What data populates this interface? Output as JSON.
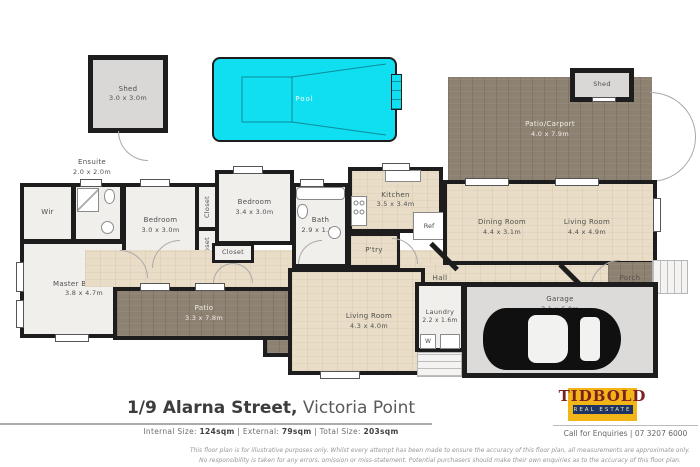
{
  "colors": {
    "wall": "#1d1d1d",
    "pool": "#10dff2",
    "wood_light": "#e9ddc7",
    "wood_dark": "#8d8172",
    "room_floor": "#f1efec",
    "garage_floor": "#dcdbd9",
    "logo_yellow": "#f2b517",
    "logo_navy": "#1d3465",
    "logo_maroon": "#7e1f1f"
  },
  "rooms": {
    "shed_tl": {
      "label": "Shed",
      "dims": "3.0 x 3.0m"
    },
    "pool": {
      "label": "Pool"
    },
    "patio_carport": {
      "label": "Patio/Carport",
      "dims": "4.0 x 7.9m"
    },
    "shed_tr": {
      "label": "Shed"
    },
    "ensuite": {
      "label": "Ensuite",
      "dims": "2.0 x 2.0m"
    },
    "wir": {
      "label": "Wir"
    },
    "bedroom_1": {
      "label": "Bedroom",
      "dims": "3.0 x 3.0m"
    },
    "bedroom_2": {
      "label": "Bedroom",
      "dims": "3.4 x 3.0m"
    },
    "closet_1": {
      "label": "Closet"
    },
    "closet_2": {
      "label": "Closet"
    },
    "closet_3": {
      "label": "Closet"
    },
    "bath": {
      "label": "Bath",
      "dims": "2.9 x 1.8m"
    },
    "kitchen": {
      "label": "Kitchen",
      "dims": "3.5 x 3.4m"
    },
    "pantry": {
      "label": "P'try"
    },
    "fridge": {
      "label": "Ref"
    },
    "dining": {
      "label": "Dining Room",
      "dims": "4.4 x 3.1m"
    },
    "living_main": {
      "label": "Living Room",
      "dims": "4.4 x 4.9m"
    },
    "hall_left": {
      "label": "Hall"
    },
    "hall_right": {
      "label": "Hall"
    },
    "master_bedroom": {
      "label": "Master Bedroom",
      "dims": "3.8 x 4.7m"
    },
    "patio": {
      "label": "Patio",
      "dims": "3.3 x 7.8m"
    },
    "living_2": {
      "label": "Living Room",
      "dims": "4.3 x 4.0m"
    },
    "laundry": {
      "label": "Laundry",
      "dims": "2.2 x 1.6m"
    },
    "washer": {
      "label": "W"
    },
    "garage": {
      "label": "Garage",
      "dims": "3.1 x 6.0m"
    },
    "porch": {
      "label": "Porch"
    }
  },
  "footer": {
    "address_primary": "1/9 Alarna Street,",
    "address_secondary": " Victoria Point",
    "sizes": {
      "internal_label": "Internal Size: ",
      "internal_value": "124sqm",
      "sep1": " | ",
      "external_label": "External: ",
      "external_value": "79sqm",
      "sep2": " | ",
      "total_label": "Total Size: ",
      "total_value": "203sqm"
    },
    "logo": {
      "name": "TIDBOLD",
      "tagline": "REAL ESTATE"
    },
    "contact": "Call for Enquiries | 07 3207 6000",
    "disclaimer_line1": "This floor plan is for illustrative purposes only. Whilst every attempt has been made to ensure the accuracy of this floor plan, all measurements are approximate only.",
    "disclaimer_line2": "No responsibility is taken for any errors, omission or miss-statement. Potential purchasers should make their own enquiries as to the accuracy of this floor plan."
  }
}
